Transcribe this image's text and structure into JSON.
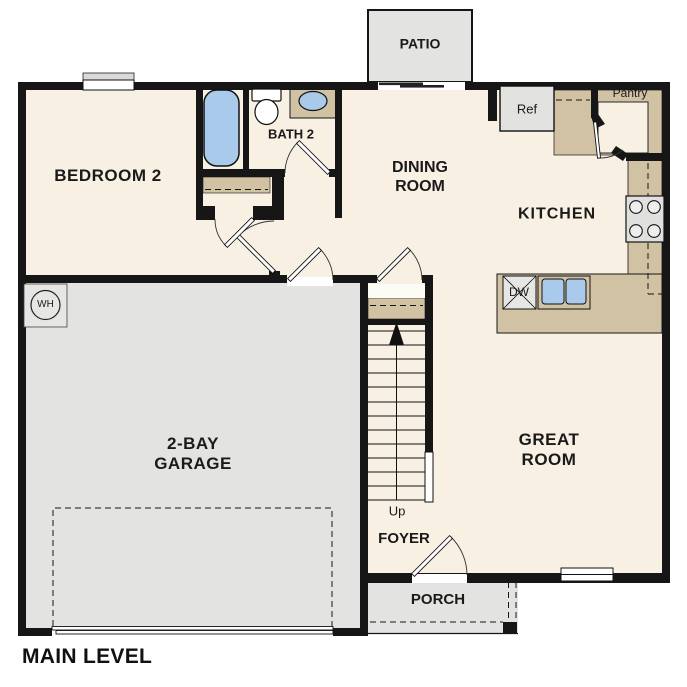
{
  "plan_title": "MAIN LEVEL",
  "labels": {
    "patio": "PATIO",
    "bedroom2": "BEDROOM 2",
    "bath2": "BATH 2",
    "dining": "DINING ROOM",
    "kitchen": "KITCHEN",
    "pantry": "Pantry",
    "refrigerator": "Ref",
    "dishwasher": "DW",
    "great_room": "GREAT ROOM",
    "garage": "2-BAY GARAGE",
    "stairs_up": "Up",
    "foyer": "FOYER",
    "porch": "PORCH",
    "water_heater": "WH"
  },
  "colors": {
    "wall": "#161616",
    "floor": "#f7f0e3",
    "garage_floor": "#e3e3e1",
    "counter_tan": "#d2c2a4",
    "fixture_blue": "#aacaec",
    "appliance_gray": "#e2e2e0",
    "text": "#1a1a1a"
  }
}
